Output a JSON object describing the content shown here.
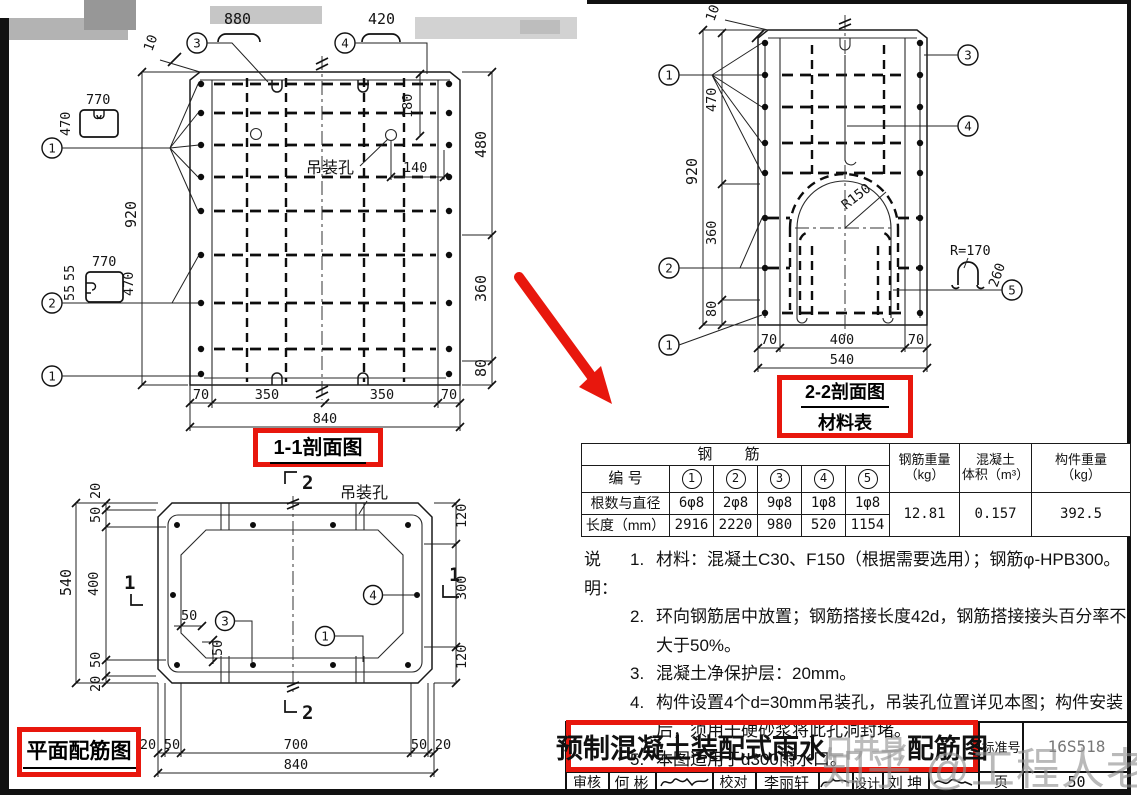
{
  "page": {
    "watermark": "知乎 @工程人老刘"
  },
  "sec11": {
    "title": "1-1剖面图",
    "hook1_dim": "880",
    "hook2_dim": "420",
    "tilt_dim": "10",
    "shape1_top": "770",
    "shape1_left": "470",
    "shape2_top": "770",
    "shape2_left_a": "55",
    "shape2_left_b": "55",
    "shape2_right": "470",
    "total_left": "920",
    "hole_label": "吊装孔",
    "dim180": "180",
    "dim140": "140",
    "right_dims": [
      "480",
      "360",
      "80"
    ],
    "bottom_dims": [
      "70",
      "350",
      "350",
      "70"
    ],
    "bottom_total": "840",
    "c1": "1",
    "c2": "2",
    "c1b": "1",
    "c3": "3",
    "c4": "4"
  },
  "plan": {
    "title": "平面配筋图",
    "hole_label": "吊装孔",
    "marker1": "1",
    "marker2": "2",
    "left_total": "540",
    "left_dims": [
      "20",
      "50",
      "400",
      "50",
      "20"
    ],
    "right_dims": [
      "120",
      "300",
      "120"
    ],
    "bottom_dims": [
      "20",
      "50",
      "700",
      "50",
      "20"
    ],
    "bottom_total": "840",
    "dim50h": "50",
    "dim50v": "50",
    "c1": "1",
    "c3": "3",
    "c4": "4"
  },
  "sec22": {
    "title": "2-2剖面图",
    "subtitle": "材料表",
    "tilt_dim": "10",
    "left_total": "920",
    "left_dims": [
      "470",
      "360",
      "80"
    ],
    "r150": "R150",
    "r170": "R=170",
    "dim260": "260",
    "bottom_dims": [
      "70",
      "400",
      "70"
    ],
    "bottom_total": "540",
    "c1": "1",
    "c2": "2",
    "c1b": "1",
    "c3": "3",
    "c4": "4",
    "c5": "5"
  },
  "table": {
    "header_rebar": "钢  筋",
    "id_label": "编  号",
    "ids": [
      "1",
      "2",
      "3",
      "4",
      "5"
    ],
    "count_label": "根数与直径",
    "counts": [
      "6φ8",
      "2φ8",
      "9φ8",
      "1φ8",
      "1φ8"
    ],
    "len_label": "长度（mm）",
    "lengths": [
      "2916",
      "2220",
      "980",
      "520",
      "1154"
    ],
    "w1": "钢筋重量",
    "w1u": "（kg）",
    "w2": "混凝土",
    "w2u": "体积（m³）",
    "w3": "构件重量",
    "w3u": "（kg）",
    "v_weight": "12.81",
    "v_concrete": "0.157",
    "v_member": "392.5"
  },
  "notes": {
    "label": "说明：",
    "items": [
      {
        "no": "1.",
        "text": "材料：混凝土C30、F150（根据需要选用）；钢筋φ-HPB300。"
      },
      {
        "no": "2.",
        "text": "环向钢筋居中放置；钢筋搭接长度42d，钢筋搭接接头百分率不大于50%。"
      },
      {
        "no": "3.",
        "text": "混凝土净保护层：20mm。"
      },
      {
        "no": "4.",
        "text": "构件设置4个d=30mm吊装孔，吊装孔位置详见本图；构件安装后，须用干硬砂浆将此孔洞封堵。"
      },
      {
        "no": "5.",
        "text": "本图适用于d300雨水口。"
      }
    ]
  },
  "titleblock": {
    "title_prefix": "预制混凝土装配式雨水",
    "title_obscured": "口井身",
    "title_suffix": "配筋图",
    "std_label": "标准号",
    "std_value": "16S518",
    "page_label": "页",
    "page_no": "50",
    "role1": "审核",
    "name1": "何 彬",
    "role2": "校对",
    "name2": "李丽轩",
    "role3": "设计",
    "name3": "刘 坤"
  }
}
